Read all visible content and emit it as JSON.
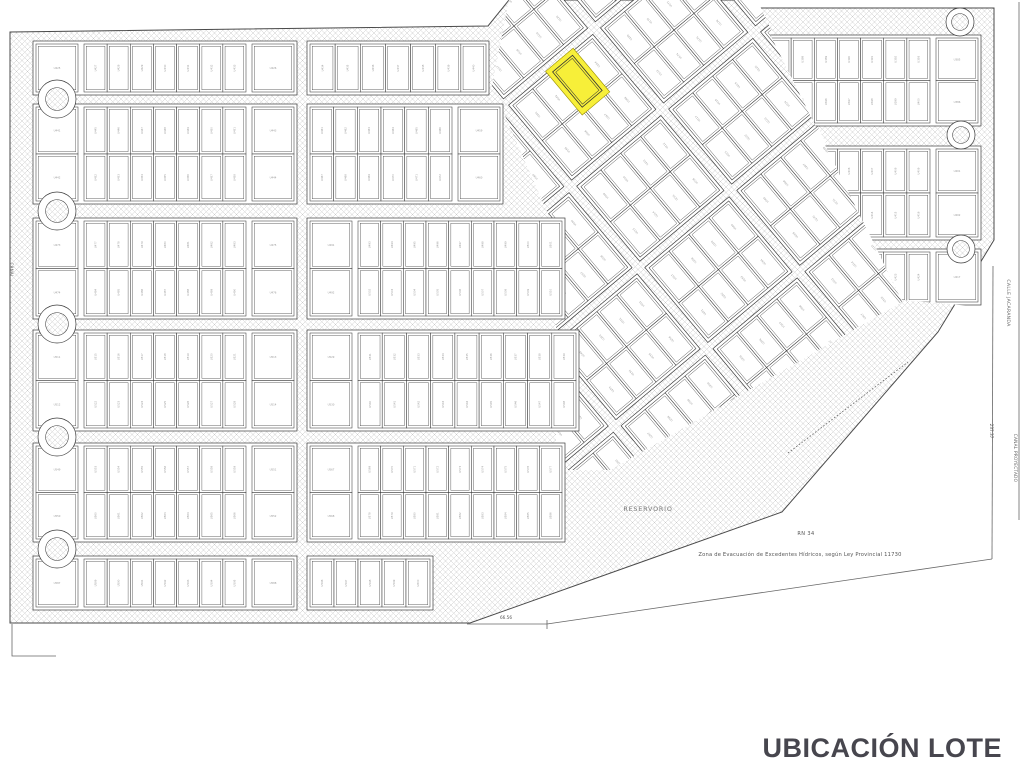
{
  "caption": "UBICACIÓN LOTE",
  "colors": {
    "background": "#ffffff",
    "line": "#3d3d3d",
    "block_edge": "#3d3d3d",
    "hatch": "#c9c9c9",
    "boundary": "#4a4a4a",
    "thin_line": "#666666",
    "label": "#6f6f6f",
    "speck": "#9a9a9a",
    "highlight_fill": "#f7ef39",
    "highlight_edge": "#9b8f00",
    "caption_color": "#47464e"
  },
  "map": {
    "lot_prefix": "U",
    "base_polygon": [
      [
        10,
        32
      ],
      [
        488,
        26
      ],
      [
        509,
        0
      ],
      [
        755,
        0
      ],
      [
        758,
        8
      ],
      [
        994,
        8
      ],
      [
        994,
        240
      ],
      [
        938,
        332
      ],
      [
        782,
        512
      ],
      [
        470,
        623
      ],
      [
        10,
        623
      ]
    ],
    "diag_clip": [
      [
        492,
        86
      ],
      [
        509,
        0
      ],
      [
        757,
        0
      ],
      [
        902,
        302
      ],
      [
        610,
        470
      ],
      [
        556,
        470
      ],
      [
        556,
        232
      ]
    ],
    "right_clip": [
      [
        755,
        4
      ],
      [
        994,
        4
      ],
      [
        994,
        308
      ],
      [
        902,
        300
      ]
    ],
    "left_bands": [
      {
        "y": 44,
        "h": 48,
        "rows": 1,
        "cols": [
          {
            "x0": 36,
            "x1": 294,
            "sqL": true,
            "sqR": true
          },
          {
            "x0": 310,
            "x1": 486,
            "sqL": false,
            "sqR": false
          }
        ]
      },
      {
        "y": 107,
        "h": 94,
        "rows": 2,
        "cols": [
          {
            "x0": 36,
            "x1": 294,
            "sqL": true,
            "sqR": true
          },
          {
            "x0": 310,
            "x1": 500,
            "sqL": false,
            "sqR": true
          }
        ]
      },
      {
        "y": 221,
        "h": 95,
        "rows": 2,
        "cols": [
          {
            "x0": 36,
            "x1": 294,
            "sqL": true,
            "sqR": true
          },
          {
            "x0": 310,
            "x1": 562,
            "sqL": true,
            "sqR": false
          }
        ]
      },
      {
        "y": 333,
        "h": 95,
        "rows": 2,
        "cols": [
          {
            "x0": 36,
            "x1": 294,
            "sqL": true,
            "sqR": true
          },
          {
            "x0": 310,
            "x1": 576,
            "sqL": true,
            "sqR": false
          }
        ]
      },
      {
        "y": 446,
        "h": 93,
        "rows": 2,
        "cols": [
          {
            "x0": 36,
            "x1": 294,
            "sqL": true,
            "sqR": true
          },
          {
            "x0": 310,
            "x1": 562,
            "sqL": true,
            "sqR": false
          }
        ]
      },
      {
        "y": 559,
        "h": 48,
        "rows": 1,
        "cols": [
          {
            "x0": 36,
            "x1": 294,
            "sqL": true,
            "sqR": true
          },
          {
            "x0": 310,
            "x1": 430,
            "sqL": false,
            "sqR": false
          }
        ]
      }
    ],
    "right_bands": [
      {
        "y": 38,
        "h": 85,
        "rows": 2
      },
      {
        "y": 149,
        "h": 88,
        "rows": 2
      },
      {
        "y": 252,
        "h": 50,
        "rows": 1
      }
    ],
    "right_zone_x": {
      "x0": 768,
      "x1": 978,
      "squares_right": true
    },
    "diag": {
      "pivot_x": 578,
      "pivot_y": 82,
      "angle": -40,
      "band_y0": 58,
      "band_h": 92,
      "band_pitch": 106,
      "bands_from": -3,
      "bands_to": 4,
      "block_x0": 513,
      "block_w": 104,
      "block_pitch": 120,
      "blocks_from": -2,
      "blocks_to": 3
    },
    "highlight": {
      "x": 560,
      "y": 53,
      "w": 36,
      "h": 57,
      "lot_x": 565,
      "lot_y": 58,
      "lot_w": 26,
      "lot_h": 46
    },
    "circles": [
      {
        "cx": 57,
        "cy": 99,
        "r": 19
      },
      {
        "cx": 57,
        "cy": 211,
        "r": 19
      },
      {
        "cx": 57,
        "cy": 324,
        "r": 19
      },
      {
        "cx": 57,
        "cy": 437,
        "r": 19
      },
      {
        "cx": 57,
        "cy": 549,
        "r": 19
      },
      {
        "cx": 960,
        "cy": 22,
        "r": 14
      },
      {
        "cx": 961,
        "cy": 135,
        "r": 14
      },
      {
        "cx": 961,
        "cy": 249,
        "r": 14
      }
    ],
    "lines": [
      {
        "name": "south-boundary-short",
        "pts": [
          [
            467,
            624
          ],
          [
            547,
            624
          ]
        ],
        "dash": false
      },
      {
        "name": "south-boundary-tick",
        "pts": [
          [
            547,
            620
          ],
          [
            547,
            629
          ]
        ],
        "dash": false
      },
      {
        "name": "south-boundary-long",
        "pts": [
          [
            547,
            624
          ],
          [
            992,
            559
          ]
        ],
        "dash": false
      },
      {
        "name": "east-boundary",
        "pts": [
          [
            993,
            266
          ],
          [
            992,
            559
          ]
        ],
        "dash": false
      },
      {
        "name": "far-east-boundary",
        "pts": [
          [
            1019,
            2
          ],
          [
            1019,
            520
          ]
        ],
        "dash": false
      },
      {
        "name": "southwest-corner-mark",
        "pts": [
          [
            12,
            624
          ],
          [
            12,
            656
          ],
          [
            56,
            656
          ]
        ],
        "dash": false
      },
      {
        "name": "servitude-note-line",
        "pts": [
          [
            788,
            453
          ],
          [
            908,
            362
          ]
        ],
        "dash": true
      }
    ],
    "labels": [
      {
        "id": "reservorio",
        "text": "RESERVORIO",
        "x": 648,
        "y": 511,
        "rot": 0,
        "size": 6.4,
        "fill": "#787878",
        "anchor": "middle",
        "spacing": 0.8
      },
      {
        "id": "route",
        "text": "RN 34",
        "x": 806,
        "y": 535,
        "rot": 0,
        "size": 5,
        "fill": "#555555",
        "anchor": "middle",
        "spacing": 0.4
      },
      {
        "id": "zona",
        "text": "Zona de Evacuación de Excedentes Hídricos, según Ley Provincial 11730",
        "x": 800,
        "y": 556,
        "rot": 0,
        "size": 5.2,
        "fill": "#555555",
        "anchor": "middle",
        "spacing": 0.2
      },
      {
        "id": "calle-jacaranda",
        "text": "CALLE JACARANDA",
        "x": 1007,
        "y": 303,
        "rot": 90,
        "size": 4.6,
        "fill": "#666666",
        "anchor": "middle",
        "spacing": 0.3
      },
      {
        "id": "canal-proyectado",
        "text": "CANAL PROYECTADO",
        "x": 1014,
        "y": 458,
        "rot": 90,
        "size": 4.2,
        "fill": "#666666",
        "anchor": "middle",
        "spacing": 0.3
      },
      {
        "id": "canal-left",
        "text": "CANAL",
        "x": 10,
        "y": 270,
        "rot": 90,
        "size": 4,
        "fill": "#666666",
        "anchor": "middle",
        "spacing": 0.3
      },
      {
        "id": "dim-south",
        "text": "66.56",
        "x": 506,
        "y": 619,
        "rot": 0,
        "size": 4.2,
        "fill": "#555555",
        "anchor": "middle",
        "spacing": 0
      },
      {
        "id": "dim-east",
        "text": "237.37",
        "x": 990,
        "y": 431,
        "rot": 90,
        "size": 4.2,
        "fill": "#555555",
        "anchor": "middle",
        "spacing": 0
      }
    ]
  }
}
